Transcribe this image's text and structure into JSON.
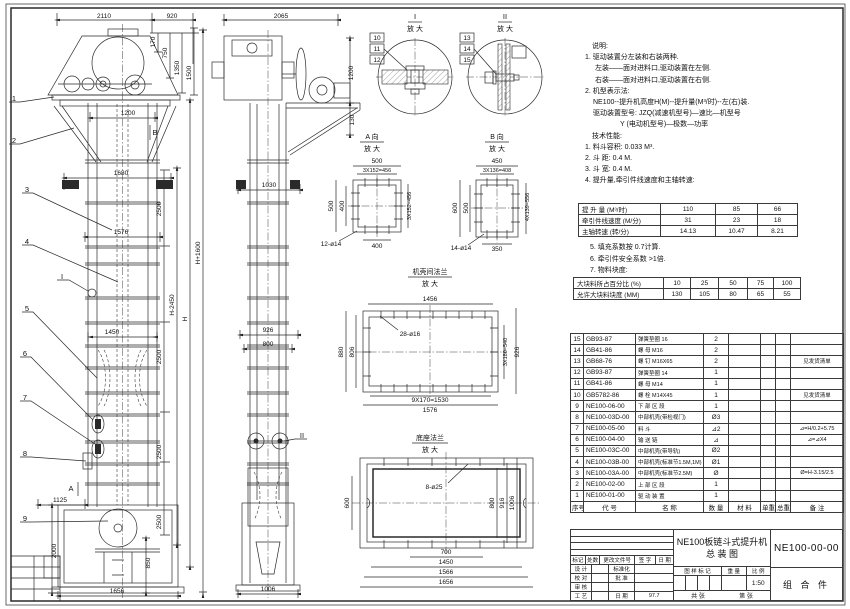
{
  "sheet": {
    "line_color": "#2a2a2a",
    "background": "#ffffff"
  },
  "notes": {
    "lines": [
      {
        "t": "说明:",
        "ind": 14
      },
      {
        "t": "1. 驱动装置分左装和右装两种.",
        "ind": 7
      },
      {
        "t": "左装——面对进料口,驱动装置在左侧.",
        "ind": 17
      },
      {
        "t": "右装——面对进料口,驱动装置在右侧.",
        "ind": 17
      },
      {
        "t": "2. 机型表示法:",
        "ind": 7
      },
      {
        "t": "NE100--提升机高度H(M)--提升量(M³/时)--左(右)装.",
        "ind": 15
      },
      {
        "t": "驱动装置型号: JZQ(减速机型号)—速比—机型号",
        "ind": 15
      },
      {
        "t": "Y (电动机型号)—极数—功率",
        "ind": 42
      },
      {
        "t": "技术性能:",
        "ind": 14
      },
      {
        "t": "1. 料斗容积: 0.033 M³.",
        "ind": 7
      },
      {
        "t": "2. 斗    距: 0.4 M.",
        "ind": 7
      },
      {
        "t": "3. 斗    宽: 0.4 M.",
        "ind": 7
      },
      {
        "t": "4. 提升量,牵引件线速度和主轴转速:",
        "ind": 7
      }
    ],
    "lines2": [
      {
        "t": "5. 填充系数按 0.7计算.",
        "ind": 0
      },
      {
        "t": "6. 牵引件安全系数 >1倍.",
        "ind": 0
      },
      {
        "t": "7. 物料块度:",
        "ind": 0
      }
    ]
  },
  "perf_table": {
    "rows": [
      {
        "label": "提 升 量  (M³/时)",
        "values": [
          "110",
          "85",
          "66"
        ]
      },
      {
        "label": "牵引件线速度 (M/分)",
        "values": [
          "31",
          "23",
          "18"
        ]
      },
      {
        "label": "主轴转速  (转/分)",
        "values": [
          "14.13",
          "10.47",
          "8.21"
        ]
      }
    ]
  },
  "lump_table": {
    "rows": [
      {
        "label": "大块料所占百分比 (%)",
        "values": [
          "10",
          "25",
          "50",
          "75",
          "100"
        ]
      },
      {
        "label": "允许大块料块度 (MM)",
        "values": [
          "130",
          "105",
          "80",
          "65",
          "55"
        ]
      }
    ]
  },
  "bom": {
    "headers": [
      "序号",
      "代  号",
      "名  称",
      "数 量",
      "材  料",
      "单重",
      "总重",
      "备  注"
    ],
    "rows": [
      {
        "seq": "15",
        "code": "GB93-87",
        "name": "弹簧垫圈 16",
        "qty": "2",
        "mat": "",
        "w1": "",
        "w2": "",
        "remark": ""
      },
      {
        "seq": "14",
        "code": "GB41-86",
        "name": "螺 母 M16",
        "qty": "2",
        "mat": "",
        "w1": "",
        "w2": "",
        "remark": ""
      },
      {
        "seq": "13",
        "code": "GB68-76",
        "name": "螺 钉 M16X65",
        "qty": "2",
        "mat": "",
        "w1": "",
        "w2": "",
        "remark": "见发货清单"
      },
      {
        "seq": "12",
        "code": "GB93-87",
        "name": "弹簧垫圈 14",
        "qty": "1",
        "mat": "",
        "w1": "",
        "w2": "",
        "remark": ""
      },
      {
        "seq": "11",
        "code": "GB41-86",
        "name": "螺 母 M14",
        "qty": "1",
        "mat": "",
        "w1": "",
        "w2": "",
        "remark": ""
      },
      {
        "seq": "10",
        "code": "GB5782-86",
        "name": "螺 栓 M14X45",
        "qty": "1",
        "mat": "",
        "w1": "",
        "w2": "",
        "remark": "见发货清单"
      },
      {
        "seq": "9",
        "code": "NE100-06-00",
        "name": "下 部 区 段",
        "qty": "1",
        "mat": "",
        "w1": "",
        "w2": "",
        "remark": ""
      },
      {
        "seq": "8",
        "code": "NE100-03D-00",
        "name": "中部机壳(带检视门)",
        "qty": "Ø3",
        "mat": "",
        "w1": "",
        "w2": "",
        "remark": ""
      },
      {
        "seq": "7",
        "code": "NE100-05-00",
        "name": "料  斗",
        "qty": "⊿2",
        "mat": "",
        "w1": "",
        "w2": "",
        "remark": "⊿=H/0.2+5.75"
      },
      {
        "seq": "6",
        "code": "NE100-04-00",
        "name": "输 送 链",
        "qty": "⊿",
        "mat": "",
        "w1": "",
        "w2": "",
        "remark": "⊿=⊿X4"
      },
      {
        "seq": "5",
        "code": "NE100-03C-00",
        "name": "中部机壳(带导轨)",
        "qty": "Ø2",
        "mat": "",
        "w1": "",
        "w2": "",
        "remark": ""
      },
      {
        "seq": "4",
        "code": "NE100-03B-00",
        "name": "中部机壳(标准节1.5M,1M)",
        "qty": "Ø1",
        "mat": "",
        "w1": "",
        "w2": "",
        "remark": ""
      },
      {
        "seq": "3",
        "code": "NE100-03A-00",
        "name": "中部机壳(标准节2.5M)",
        "qty": "Ø",
        "mat": "",
        "w1": "",
        "w2": "",
        "remark": "Ø=H-3.15/2.5"
      },
      {
        "seq": "2",
        "code": "NE100-02-00",
        "name": "上 部 区 段",
        "qty": "1",
        "mat": "",
        "w1": "",
        "w2": "",
        "remark": ""
      },
      {
        "seq": "1",
        "code": "NE100-01-00",
        "name": "驱 动 装 置",
        "qty": "1",
        "mat": "",
        "w1": "",
        "w2": "",
        "remark": ""
      }
    ]
  },
  "titleblock": {
    "rev_headers": [
      "标记",
      "处数",
      "更改文件号",
      "签 字",
      "日 期"
    ],
    "rows": [
      [
        "设 计",
        "",
        "标准化",
        ""
      ],
      [
        "校 对",
        "",
        "批 准",
        ""
      ],
      [
        "审 核",
        "",
        "",
        ""
      ],
      [
        "工 艺",
        "",
        "日 期",
        "97.7"
      ]
    ],
    "stamp_headers": [
      "图 样 标 记",
      "重 量",
      "比 例"
    ],
    "scale": "1:50",
    "sheet_count": "共  张",
    "sheet_no": "第  张",
    "title1": "NE100板链斗式提升机",
    "title2": "总  装  图",
    "drawing_no": "NE100-00-00",
    "part_class": "组 合 件"
  },
  "details": {
    "i": {
      "t": "I",
      "mag": "放 大"
    },
    "ii": {
      "t": "II",
      "mag": "放 大"
    },
    "a": {
      "t": "A 向",
      "mag": "放 大"
    },
    "b": {
      "t": "B 向",
      "mag": "放 大"
    },
    "flange": {
      "t": "机壳间法兰",
      "mag": "放 大"
    },
    "base": {
      "t": "底座法兰",
      "mag": "放 大"
    }
  },
  "balloons": {
    "n1": "1",
    "n2": "2",
    "n3": "3",
    "n4": "4",
    "n5": "5",
    "n6": "6",
    "n7": "7",
    "n8": "8",
    "n9": "9",
    "n10": "10",
    "n11": "11",
    "n12": "12",
    "n13": "13",
    "n14": "14",
    "n15": "15"
  },
  "dims": {
    "d2110": "2110",
    "d920": "920",
    "d170": "170",
    "d750": "750",
    "d1350": "1350",
    "d1500": "1500",
    "d1200": "1200",
    "d1680": "1680",
    "d2500": "2500",
    "d1576": "1576",
    "d1450": "1450",
    "dH2450": "H-2450",
    "dH": "H",
    "dH1600": "H+1600",
    "d1125": "1125",
    "d2000": "2000",
    "d850": "850",
    "d1656": "1656",
    "d2065": "2065",
    "d130": "130",
    "d1030": "1030",
    "d926": "926",
    "d800": "800",
    "d1006": "1006",
    "d500": "500",
    "d3x152": "3X152=456",
    "d400": "400",
    "d12o14": "12-ø14",
    "d450": "450",
    "d3x136": "3X136=408",
    "d600": "600",
    "d4x139": "4X139=556",
    "d350": "350",
    "d14o14": "14-ø14",
    "d1456": "1456",
    "d28o16": "28-ø16",
    "d880": "880",
    "d806": "806",
    "d3x180": "3X180=540",
    "d9x170": "9X170=1530",
    "d8o25": "8-ø25",
    "d916": "916",
    "d700": "700",
    "d1566": "1566",
    "vA": "A",
    "vB": "B",
    "mI": "I",
    "mII": "II"
  }
}
